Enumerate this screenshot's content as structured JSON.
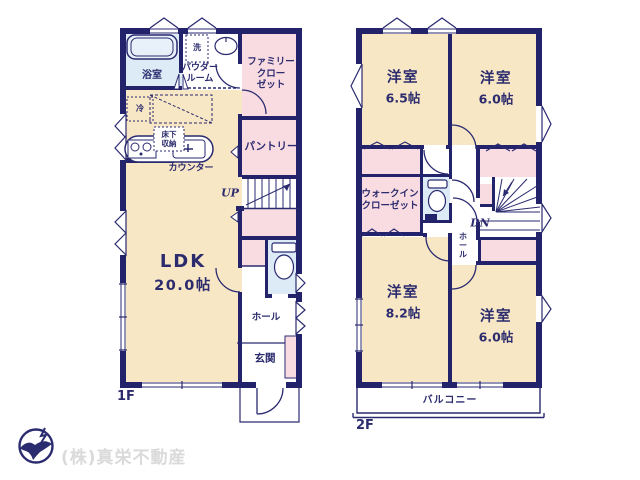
{
  "image_type": "real-estate floor plan",
  "colors": {
    "wall_navy": "#23236B",
    "line_navy": "#2A2A70",
    "room_cream": "#F7E7C5",
    "closet_pink": "#F9DCE1",
    "wet_area_blue": "#DCEBF5",
    "label_navy": "#2B2B6E",
    "footer_gray": "#DADADA",
    "background": "#FFFFFF"
  },
  "floor1": {
    "floor_label": "1F",
    "labels": {
      "ldk_name": "LDK",
      "ldk_size": "20.0帖",
      "bathroom": "浴室",
      "washer": "洗",
      "powder_room": "パウダー\nルーム",
      "family_closet": "ファミリー\nクロー\nゼット",
      "fridge": "冷",
      "underfloor_storage": "床下\n収納",
      "counter": "カウンター",
      "pantry": "パントリー",
      "stairs": "UP",
      "hall": "ホール",
      "entrance": "玄関"
    }
  },
  "floor2": {
    "floor_label": "2F",
    "labels": {
      "bedroom_nw_name": "洋室",
      "bedroom_nw_size": "6.5帖",
      "bedroom_ne_name": "洋室",
      "bedroom_ne_size": "6.0帖",
      "walk_in_closet": "ウォークイン\nクローゼット",
      "stairs": "DN",
      "hall": "ホ\nー\nル",
      "bedroom_sw_name": "洋室",
      "bedroom_sw_size": "8.2帖",
      "bedroom_se_name": "洋室",
      "bedroom_se_size": "6.0帖",
      "balcony": "バルコニー"
    }
  },
  "footer": {
    "company_name": "(株)真栄不動産"
  }
}
